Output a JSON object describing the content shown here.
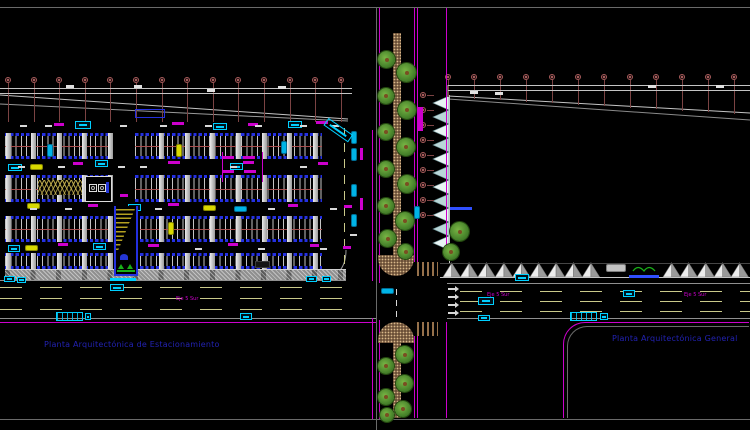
{
  "titles": {
    "left": "Planta Arquitectónica de Estacionamiento",
    "right": "Planta Arquitectónica General"
  },
  "road_labels": {
    "left": "Eje 5 Sur",
    "right_1": "Eje 5 Sur",
    "right_2": "Eje 5 Sur"
  },
  "colors": {
    "background": "#000000",
    "frame_line": "#6a6a6a",
    "grid_axis": "#a85c5c",
    "stall_blue": "#2430e0",
    "annotation_cyan": "#00cfff",
    "car_yellow": "#d8d800",
    "magenta": "#cc00cc",
    "lane_dash": "#c9c98a",
    "title_blue": "#2222b2",
    "tree_green": "#46822a",
    "planter_brown": "#6b4f37",
    "ramp_hatch": "#b4a020",
    "sawtooth_gray": "#9a9a9a",
    "line_white": "#d4d4d4"
  },
  "graphics": {
    "left_grid": {
      "x0": 8,
      "dx": 25.6,
      "n": 14,
      "cy": 80,
      "ly0": 83,
      "ly1": 122
    },
    "right_grid": {
      "x0": 448,
      "dx": 26,
      "n": 12,
      "cy": 77,
      "ly0": 80,
      "diag": [
        448,
        97,
        750,
        115
      ]
    },
    "rcircles": {
      "x": 423,
      "ys": [
        95,
        110,
        125,
        140,
        155,
        170,
        185,
        200,
        215
      ]
    },
    "columns_x": [
      8,
      33.6,
      59.2,
      84.8,
      110.4,
      136,
      161.6,
      187.2,
      212.8,
      238.4,
      264,
      289.6,
      315.2
    ],
    "bands": [
      {
        "y": 133,
        "h": 26,
        "segs": [
          [
            5,
            107
          ],
          [
            135,
            187
          ]
        ],
        "mid": 1
      },
      {
        "y": 175,
        "h": 27,
        "segs": [
          [
            5,
            107
          ],
          [
            135,
            187
          ]
        ],
        "mid": 1
      },
      {
        "y": 216,
        "h": 26,
        "segs": [
          [
            5,
            107
          ],
          [
            140,
            182
          ]
        ],
        "mid": 1
      },
      {
        "y": 253,
        "h": 16,
        "segs": [
          [
            5,
            107
          ],
          [
            140,
            182
          ]
        ],
        "mid": 0
      }
    ],
    "lines": [
      [
        "h",
        0,
        88,
        352,
        "lw"
      ],
      [
        "h",
        0,
        93,
        352,
        "lw"
      ],
      [
        "h",
        448,
        85,
        302,
        "lw"
      ],
      [
        "h",
        448,
        90,
        302,
        "lw"
      ],
      [
        "h",
        0,
        280,
        346,
        "lg"
      ],
      [
        "h",
        447,
        283,
        303,
        "lg"
      ],
      [
        "h",
        0,
        318,
        376,
        "lg"
      ],
      [
        "h",
        447,
        318,
        303,
        "lg"
      ],
      [
        "h",
        0,
        322,
        376,
        "lm"
      ],
      [
        "h",
        440,
        263,
        310,
        "ld"
      ],
      [
        "h",
        440,
        277,
        310,
        "lw"
      ],
      [
        "h",
        0,
        287,
        345,
        "dh"
      ],
      [
        "h",
        0,
        298,
        345,
        "dh"
      ],
      [
        "h",
        0,
        309,
        345,
        "dh"
      ],
      [
        "h",
        460,
        291,
        290,
        "dh"
      ],
      [
        "h",
        460,
        301,
        290,
        "dh"
      ],
      [
        "h",
        460,
        311,
        290,
        "dh"
      ],
      [
        "v",
        344,
        128,
        152,
        "dv"
      ],
      [
        "v",
        396,
        285,
        32,
        "wv"
      ],
      [
        "v",
        372,
        130,
        151,
        "lm"
      ],
      [
        "v",
        372,
        318,
        101,
        "lm"
      ],
      [
        "v",
        379,
        8,
        275,
        "lm"
      ],
      [
        "v",
        379,
        320,
        99,
        "lm"
      ],
      [
        "v",
        414,
        8,
        254,
        "lm"
      ],
      [
        "v",
        417,
        8,
        254,
        "lm"
      ],
      [
        "v",
        414,
        336,
        82,
        "lm"
      ],
      [
        "v",
        417,
        336,
        82,
        "lm"
      ],
      [
        "v",
        446,
        8,
        250,
        "lm"
      ],
      [
        "v",
        446,
        322,
        96,
        "lm"
      ],
      [
        "v",
        449,
        95,
        168,
        "lw"
      ],
      [
        "v",
        222,
        152,
        30,
        "lm"
      ],
      [
        "v",
        262,
        152,
        30,
        "lm"
      ]
    ],
    "rects": [
      [
        393,
        33,
        8,
        222,
        "planter"
      ],
      [
        378,
        255,
        36,
        21,
        "planter capb"
      ],
      [
        378,
        322,
        36,
        21,
        "planter capt"
      ],
      [
        393,
        343,
        8,
        75,
        "planter"
      ],
      [
        417,
        262,
        21,
        14,
        "cross"
      ],
      [
        417,
        322,
        21,
        14,
        "cross"
      ],
      [
        418,
        107,
        5,
        24,
        "busstop"
      ],
      [
        5,
        269,
        341,
        11,
        "sidewalk"
      ],
      [
        255,
        261,
        15,
        7,
        "darkbox"
      ],
      [
        606,
        264,
        20,
        8,
        "graycar"
      ],
      [
        56,
        312,
        27,
        9,
        "scalebox"
      ],
      [
        570,
        312,
        27,
        9,
        "scalebox"
      ],
      [
        563,
        322,
        186,
        96,
        "corner-m"
      ],
      [
        567,
        326,
        182,
        92,
        "corner-g"
      ],
      [
        135,
        109,
        30,
        9,
        "bluebox"
      ]
    ],
    "cars": [
      [
        47,
        144,
        "v",
        "cyan"
      ],
      [
        176,
        144,
        "v",
        "yellow"
      ],
      [
        281,
        141,
        "v",
        "cyan"
      ],
      [
        30,
        164,
        "h",
        "yellow"
      ],
      [
        27,
        203,
        "h",
        "yellow"
      ],
      [
        203,
        205,
        "h",
        "yellow"
      ],
      [
        234,
        206,
        "h",
        "cyan"
      ],
      [
        168,
        222,
        "v",
        "yellow"
      ],
      [
        25,
        245,
        "h",
        "yellow"
      ],
      [
        351,
        131,
        "v",
        "cyan"
      ],
      [
        351,
        148,
        "v",
        "cyan"
      ],
      [
        351,
        184,
        "v",
        "cyan"
      ],
      [
        351,
        214,
        "v",
        "cyan"
      ],
      [
        381,
        288,
        "h",
        "cyan"
      ],
      [
        414,
        206,
        "v",
        "cyan"
      ]
    ],
    "badges": [
      [
        75,
        121,
        16,
        8
      ],
      [
        213,
        123,
        14,
        7
      ],
      [
        288,
        121,
        14,
        7
      ],
      [
        8,
        164,
        14,
        7
      ],
      [
        95,
        160,
        13,
        7
      ],
      [
        230,
        163,
        13,
        7
      ],
      [
        128,
        204,
        13,
        7
      ],
      [
        93,
        243,
        13,
        7
      ],
      [
        8,
        245,
        12,
        7
      ],
      [
        110,
        284,
        14,
        7
      ],
      [
        240,
        313,
        12,
        7
      ],
      [
        306,
        276,
        11,
        6
      ],
      [
        322,
        276,
        9,
        6
      ],
      [
        4,
        276,
        11,
        6
      ],
      [
        17,
        277,
        9,
        6
      ],
      [
        515,
        274,
        14,
        7
      ],
      [
        478,
        297,
        16,
        8
      ],
      [
        623,
        290,
        12,
        7
      ],
      [
        478,
        315,
        12,
        6
      ],
      [
        85,
        313,
        6,
        7
      ],
      [
        600,
        313,
        8,
        7
      ]
    ],
    "smudges": [
      [
        54,
        123,
        10
      ],
      [
        172,
        122,
        12
      ],
      [
        248,
        123,
        10
      ],
      [
        316,
        121,
        12
      ],
      [
        73,
        162,
        10
      ],
      [
        168,
        161,
        12
      ],
      [
        243,
        161,
        11
      ],
      [
        318,
        162,
        10
      ],
      [
        222,
        156,
        12
      ],
      [
        243,
        156,
        12
      ],
      [
        222,
        170,
        12
      ],
      [
        244,
        170,
        12
      ],
      [
        88,
        204,
        10
      ],
      [
        168,
        203,
        11
      ],
      [
        288,
        204,
        10
      ],
      [
        344,
        205,
        8
      ],
      [
        58,
        243,
        10
      ],
      [
        148,
        244,
        11
      ],
      [
        228,
        243,
        10
      ],
      [
        310,
        244,
        9
      ],
      [
        343,
        246,
        8
      ],
      [
        120,
        194,
        8
      ],
      [
        88,
        197,
        14,
        "c"
      ],
      [
        110,
        278,
        26,
        "c"
      ],
      [
        629,
        275,
        30,
        "b"
      ],
      [
        450,
        207,
        22,
        "b"
      ],
      [
        360,
        148,
        12,
        "mv"
      ],
      [
        360,
        198,
        12,
        "mv"
      ]
    ],
    "arrows": [
      [
        18,
        166
      ],
      [
        58,
        166
      ],
      [
        118,
        166
      ],
      [
        140,
        166
      ],
      [
        230,
        166
      ],
      [
        300,
        166
      ],
      [
        30,
        208
      ],
      [
        65,
        208
      ],
      [
        155,
        208
      ],
      [
        268,
        208
      ],
      [
        330,
        208
      ],
      [
        120,
        248
      ],
      [
        195,
        248
      ],
      [
        258,
        248
      ],
      [
        320,
        248
      ],
      [
        20,
        125
      ],
      [
        45,
        125
      ],
      [
        120,
        125
      ],
      [
        160,
        125
      ],
      [
        205,
        125
      ],
      [
        255,
        125
      ],
      [
        300,
        125
      ],
      [
        332,
        125
      ],
      [
        350,
        234
      ],
      [
        448,
        288,
        "r"
      ],
      [
        448,
        296,
        "r"
      ],
      [
        448,
        304,
        "r"
      ],
      [
        448,
        312,
        "r"
      ]
    ],
    "dims": [
      [
        66,
        85
      ],
      [
        134,
        85
      ],
      [
        278,
        86
      ],
      [
        207,
        89
      ],
      [
        470,
        91
      ],
      [
        495,
        92
      ],
      [
        648,
        85
      ],
      [
        716,
        85
      ]
    ],
    "trees": [
      [
        378,
        51,
        17
      ],
      [
        397,
        63,
        19
      ],
      [
        378,
        88,
        16
      ],
      [
        398,
        101,
        18
      ],
      [
        378,
        124,
        16
      ],
      [
        397,
        138,
        18
      ],
      [
        378,
        161,
        16
      ],
      [
        398,
        175,
        18
      ],
      [
        378,
        198,
        16
      ],
      [
        396,
        212,
        18
      ],
      [
        379,
        230,
        17
      ],
      [
        398,
        244,
        15
      ],
      [
        450,
        222,
        19
      ],
      [
        443,
        244,
        16
      ],
      [
        396,
        346,
        17
      ],
      [
        378,
        358,
        16
      ],
      [
        396,
        375,
        17
      ],
      [
        378,
        389,
        16
      ],
      [
        395,
        401,
        16
      ],
      [
        380,
        408,
        14
      ]
    ],
    "facade_teeth": {
      "x": 449,
      "apex": 433,
      "y0": 96,
      "step": 14,
      "n": 11
    },
    "teeth_bottom_x": [
      443,
      460.4,
      477.8,
      495.2,
      512.6,
      530,
      547.4,
      564.8,
      582.2,
      663,
      680,
      697,
      714,
      731
    ]
  }
}
